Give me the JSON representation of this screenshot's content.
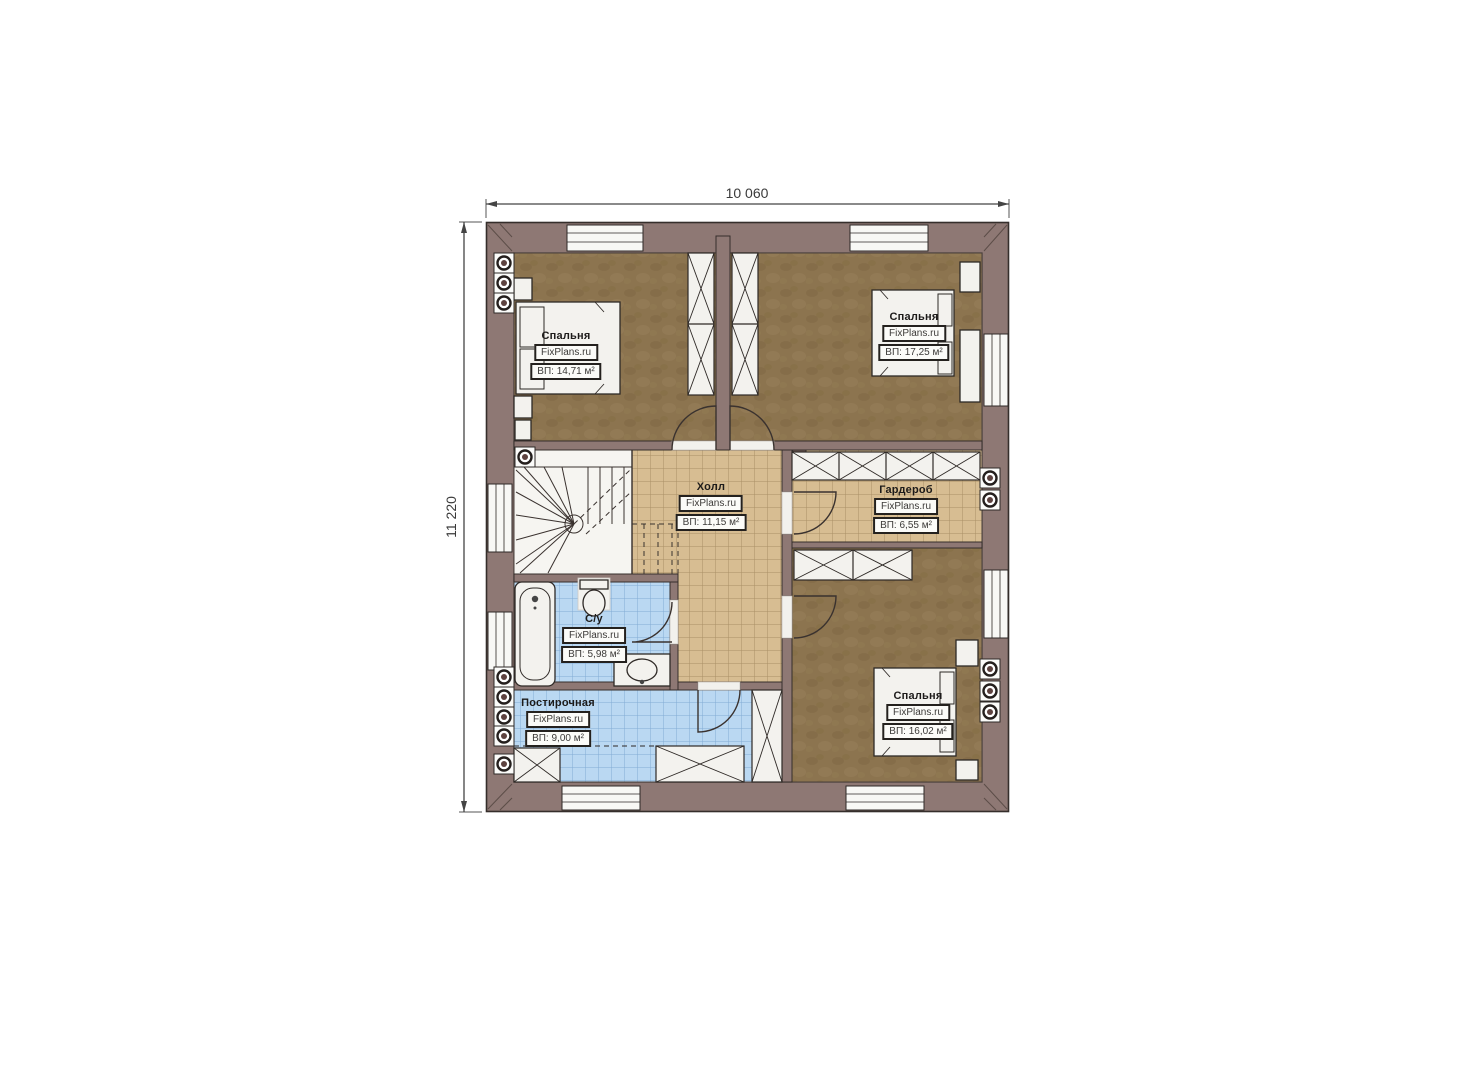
{
  "plan": {
    "dimension_width": "10 060",
    "dimension_height": "11 220"
  },
  "rooms": [
    {
      "id": "bedroom-top-left",
      "name": "Спальня",
      "brand": "FixPlans.ru",
      "area": "ВП: 14,71 м²"
    },
    {
      "id": "bedroom-top-right",
      "name": "Спальня",
      "brand": "FixPlans.ru",
      "area": "ВП: 17,25 м²"
    },
    {
      "id": "hall",
      "name": "Холл",
      "brand": "FixPlans.ru",
      "area": "ВП: 11,15 м²"
    },
    {
      "id": "wardrobe",
      "name": "Гардероб",
      "brand": "FixPlans.ru",
      "area": "ВП: 6,55 м²"
    },
    {
      "id": "bathroom",
      "name": "С/у",
      "brand": "FixPlans.ru",
      "area": "ВП: 5,98 м²"
    },
    {
      "id": "laundry",
      "name": "Постирочная",
      "brand": "FixPlans.ru",
      "area": "ВП: 9,00 м²"
    },
    {
      "id": "bedroom-bottom-right",
      "name": "Спальня",
      "brand": "FixPlans.ru",
      "area": "ВП: 16,02 м²"
    }
  ],
  "colors": {
    "wall": "#8e7874",
    "wall_outline": "#352e2b",
    "floor_wood": "#8c744f",
    "floor_tile_tan": "#d7bd92",
    "floor_tile_blue": "#bad8f2",
    "furniture_white": "#f3f2ee",
    "dimension_text": "#3a3a3a",
    "vent_center": "#5d423f"
  }
}
